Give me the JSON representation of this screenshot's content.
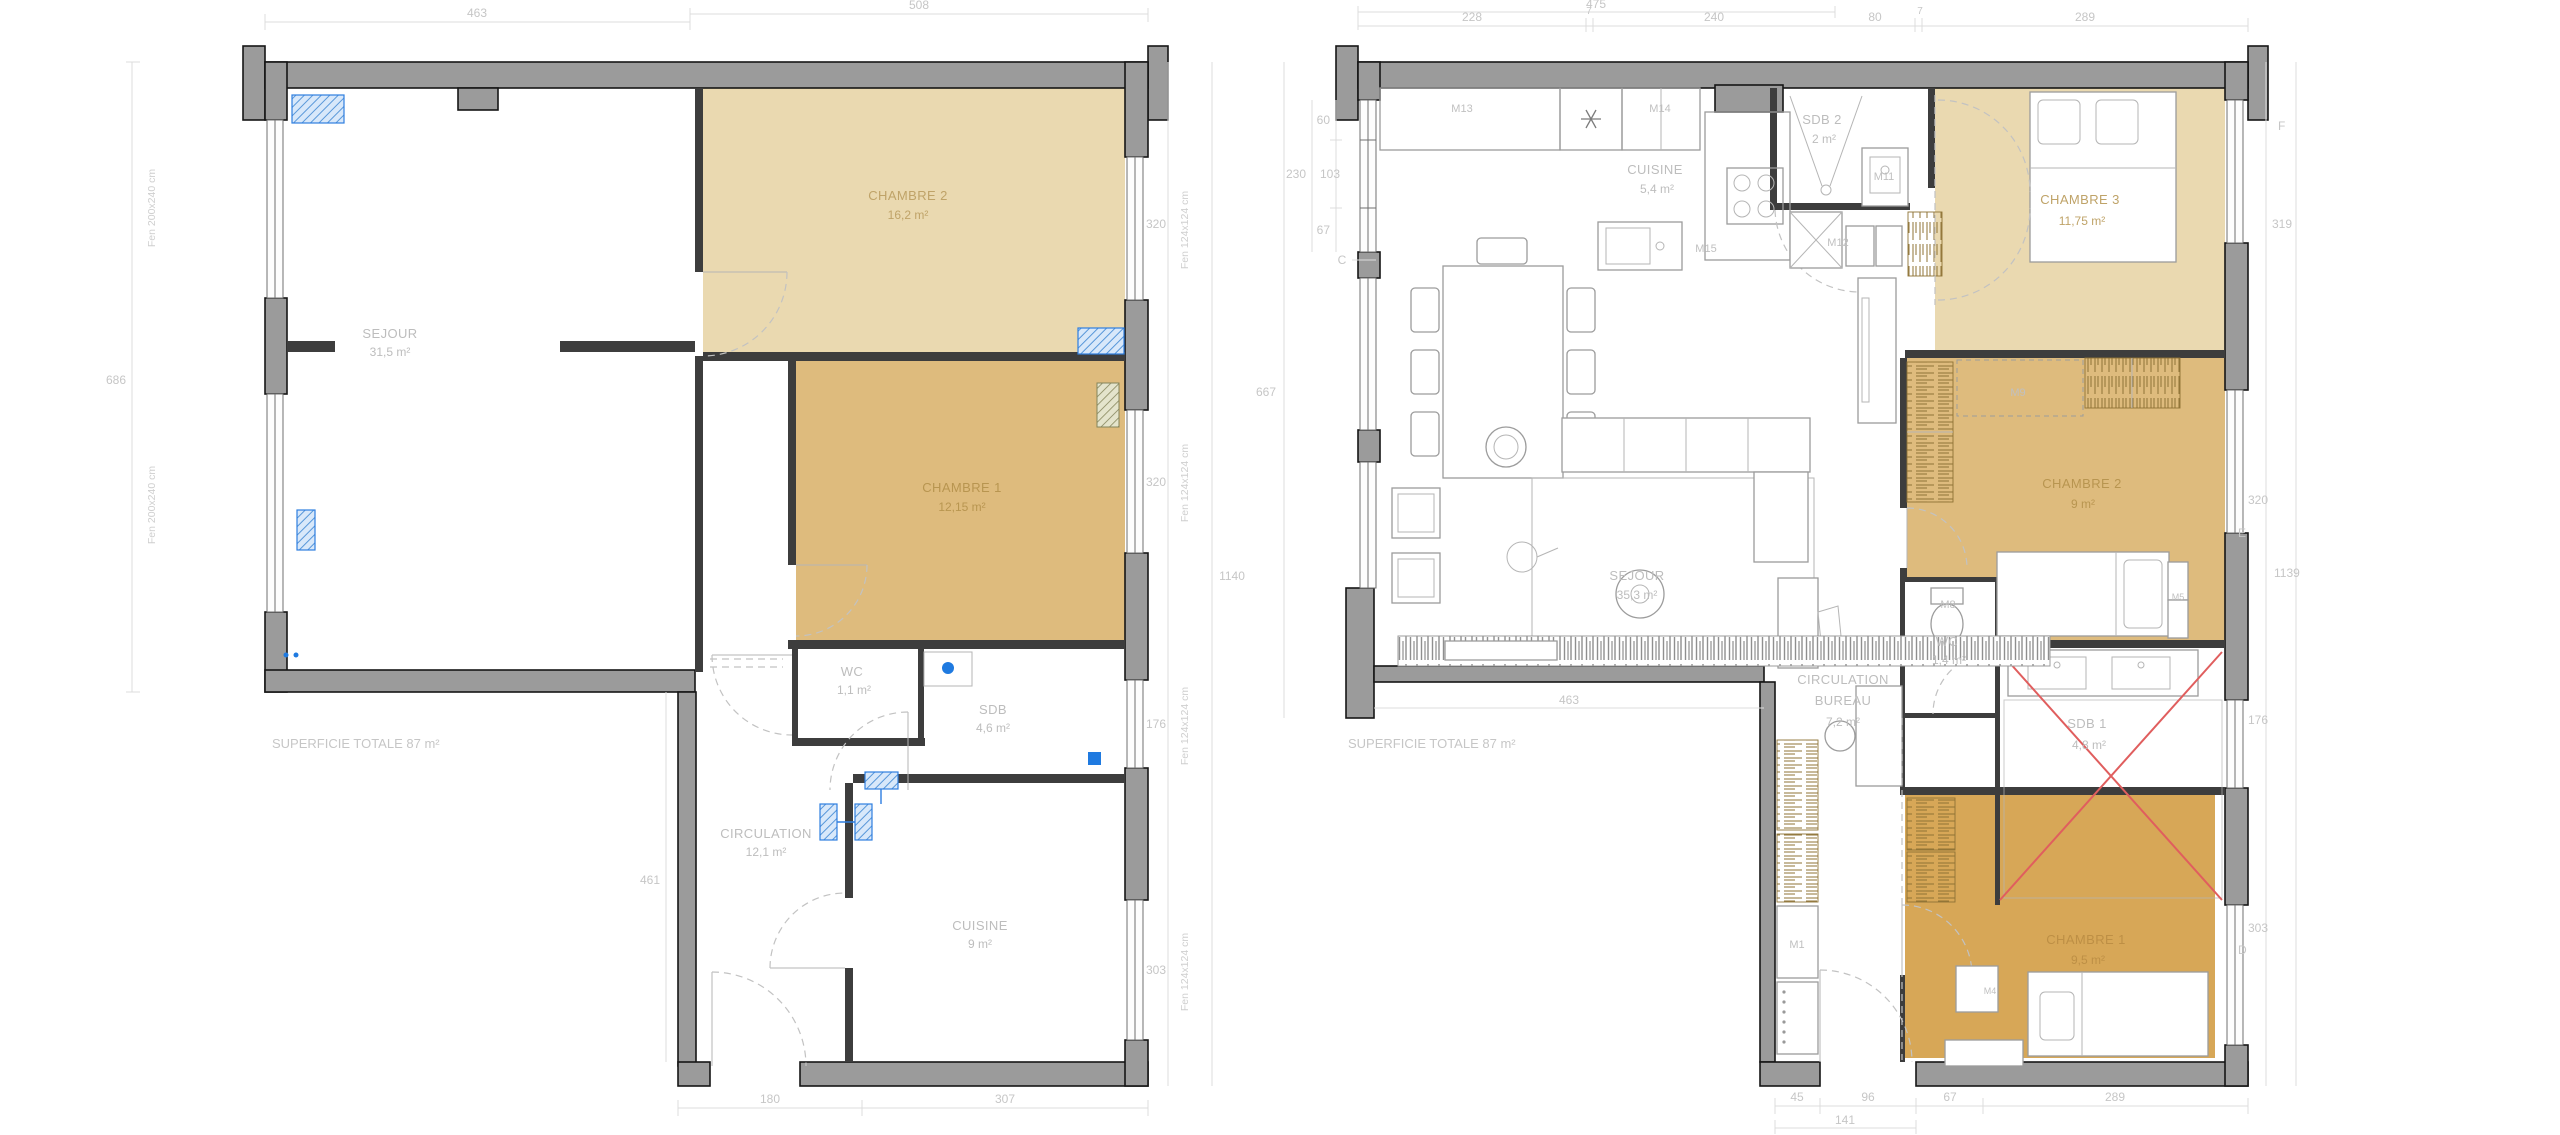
{
  "colors": {
    "wall_gray": "#9b9b9b",
    "tan_light": "#ead9b0",
    "tan_mid": "#debb7d",
    "tan_dark": "#d7a757",
    "marker_blue": "#1f7ae0",
    "demolition_red": "#e05e5e",
    "dim_text": "#c6c6c6"
  },
  "left_plan": {
    "superficie": "SUPERFICIE TOTALE 87 m²",
    "rooms": {
      "sejour": {
        "name": "SEJOUR",
        "area": "31,5 m²"
      },
      "chambre2": {
        "name": "CHAMBRE 2",
        "area": "16,2 m²"
      },
      "chambre1": {
        "name": "CHAMBRE 1",
        "area": "12,15 m²"
      },
      "wc": {
        "name": "WC",
        "area": "1,1 m²"
      },
      "sdb": {
        "name": "SDB",
        "area": "4,6 m²"
      },
      "circulation": {
        "name": "CIRCULATION",
        "area": "12,1 m²"
      },
      "cuisine": {
        "name": "CUISINE",
        "area": "9 m²"
      }
    },
    "dims": {
      "top_left": "463",
      "top_right": "508",
      "left_height": "686",
      "lower_left_height": "461",
      "win_ch2": "320",
      "win_ch1": "320",
      "total_height": "1140",
      "win_sdb": "176",
      "win_cuisine": "303",
      "bottom_left": "180",
      "bottom_right": "307"
    },
    "windows": {
      "fen_left": "Fen 200x240 cm",
      "fen_right": "Fen 124x124 cm"
    }
  },
  "right_plan": {
    "superficie": "SUPERFICIE TOTALE 87 m²",
    "rooms": {
      "cuisine": {
        "name": "CUISINE",
        "area": "5,4 m²"
      },
      "sdb2": {
        "name": "SDB 2",
        "area": "2 m²"
      },
      "chambre3": {
        "name": "CHAMBRE 3",
        "area": "11,75 m²"
      },
      "chambre2": {
        "name": "CHAMBRE 2",
        "area": "9 m²"
      },
      "wc": {
        "name": "WC",
        "area": "1,4 m²"
      },
      "circulation": {
        "name": "CIRCULATION",
        "line2": "BUREAU",
        "area": "7,2 m²"
      },
      "sdb1": {
        "name": "SDB 1",
        "area": "4,8 m²"
      },
      "sejour": {
        "name": "SEJOUR",
        "area": "35,3 m²"
      },
      "chambre1": {
        "name": "CHAMBRE 1",
        "area": "9,5 m²"
      }
    },
    "modules": {
      "m1": "M1",
      "m4": "M4",
      "m5": "M5",
      "m8": "M8",
      "m9": "M9",
      "m11": "M11",
      "m12": "M12",
      "m13": "M13",
      "m14": "M14",
      "m15": "M15"
    },
    "dims": {
      "top_total": "475",
      "top_1": "228",
      "top_2": "7",
      "top_3": "240",
      "top_4": "80",
      "top_5": "7",
      "top_6": "289",
      "left_1": "60",
      "left_2": "230",
      "left_3": "103",
      "left_4": "67",
      "left_total": "667",
      "right_1": "319",
      "right_2": "320",
      "right_total": "1139",
      "right_3": "176",
      "right_4": "303",
      "bottom_1": "45",
      "bottom_2": "96",
      "bottom_3": "67",
      "bottom_4": "289",
      "bottom_sub": "141",
      "sejour_width": "463"
    },
    "markers": {
      "c": "C",
      "d": "D",
      "e": "E",
      "f": "F"
    }
  }
}
